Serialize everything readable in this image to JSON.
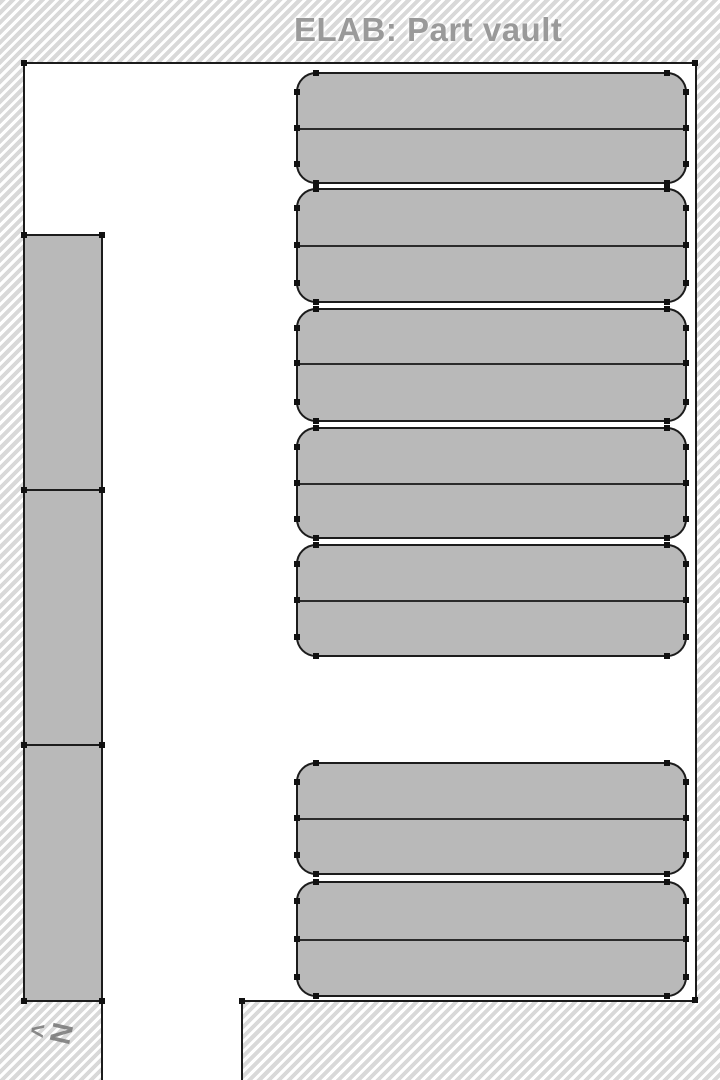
{
  "title": "ELAB: Part vault",
  "compass": {
    "arrow_glyph": "<",
    "letter": "N"
  },
  "colors": {
    "hatch_stripe": "#d9d9d9",
    "wall": "#1c1c1c",
    "shelf_fill": "#b9b9b9",
    "divider": "#2b2b2b",
    "marker": "#111111",
    "title_text": "#9a9a9a",
    "compass_text": "rgba(110,110,110,0.8)"
  },
  "map": {
    "room": {
      "x": 23,
      "y": 62,
      "width": 674,
      "height": 940
    },
    "corridor": {
      "x": 101,
      "y": 999,
      "width": 142,
      "height": 81
    },
    "wall_markers": [
      [
        24,
        63
      ],
      [
        695,
        63
      ],
      [
        695,
        1000
      ],
      [
        242,
        1001
      ]
    ],
    "left_rack": {
      "sections": [
        {
          "x": 23,
          "y": 234,
          "width": 80,
          "height": 257
        },
        {
          "x": 23,
          "y": 489,
          "width": 80,
          "height": 257
        },
        {
          "x": 23,
          "y": 744,
          "width": 80,
          "height": 258
        }
      ],
      "markers": [
        [
          24,
          235
        ],
        [
          102,
          235
        ],
        [
          24,
          490
        ],
        [
          102,
          490
        ],
        [
          24,
          745
        ],
        [
          102,
          745
        ],
        [
          24,
          1001
        ],
        [
          102,
          1001
        ]
      ]
    },
    "shelf_x": 296,
    "shelf_width": 391,
    "corner_radius": 20,
    "shelf_groups": [
      {
        "y": 72,
        "height": 112,
        "mid": 56
      },
      {
        "y": 188,
        "height": 115,
        "mid": 57
      },
      {
        "y": 308,
        "height": 114,
        "mid": 55
      },
      {
        "y": 427,
        "height": 112,
        "mid": 56
      },
      {
        "y": 544,
        "height": 113,
        "mid": 56
      },
      {
        "y": 762,
        "height": 113,
        "mid": 56
      },
      {
        "y": 881,
        "height": 116,
        "mid": 58
      }
    ]
  }
}
